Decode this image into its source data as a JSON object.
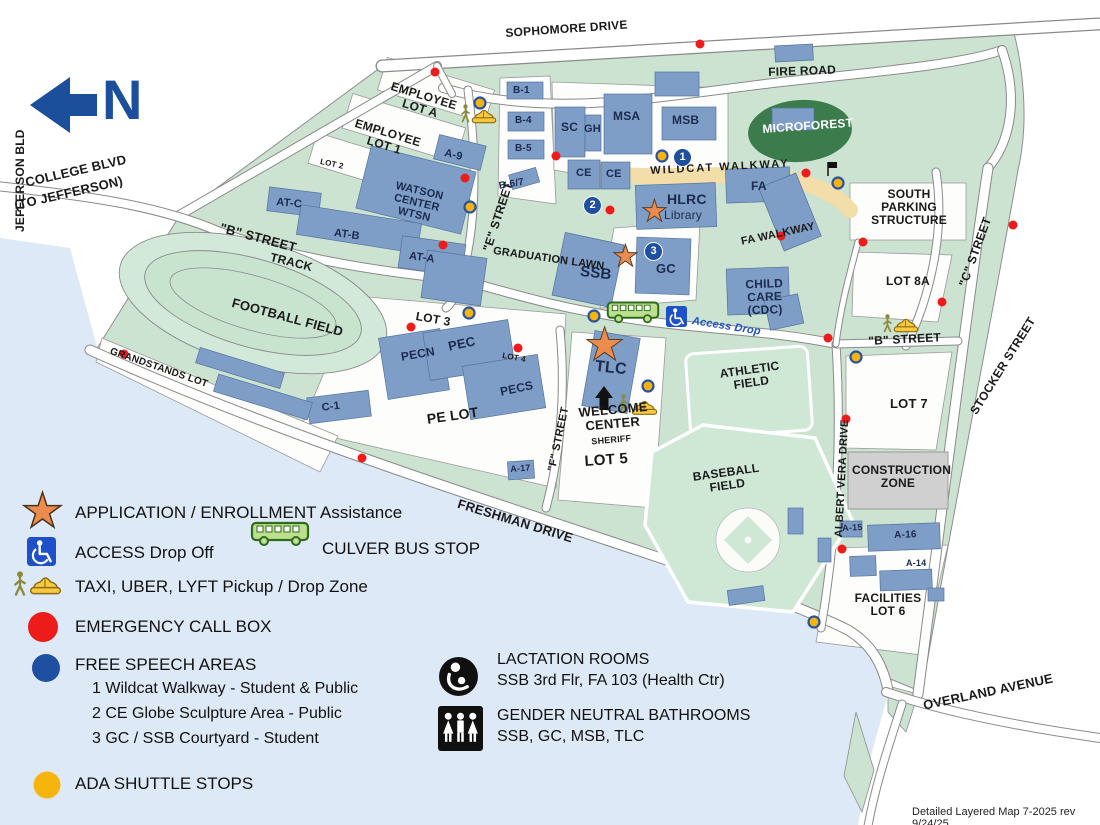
{
  "colors": {
    "campus_green": "#CBE3D0",
    "water_blue": "#DDE9F6",
    "building_blue": "#7E9EC8",
    "microforest_green": "#3B7B4C",
    "walkway_tan": "#F3DDA8",
    "construction_gray": "#D0D0D0",
    "emergency_red": "#EE1B1B",
    "ada_yellow": "#F6B40D",
    "free_speech_blue": "#1E4FA0",
    "star_orange": "#EB8B4D",
    "north_blue": "#1B4F9C",
    "access_blue": "#1E50C8",
    "bus_green": "#BCE08E",
    "taxi_yellow": "#F8C93E"
  },
  "icons": {
    "star": "★"
  },
  "north": {
    "label": "N"
  },
  "roads": {
    "jefferson_bld": "JEFFERSON BLD",
    "college_blvd": "COLLEGE BLVD",
    "to_jefferson": "(TO JEFFERSON)",
    "sophomore_drive": "SOPHOMORE DRIVE",
    "fire_road": "FIRE ROAD",
    "b_street_west": "\"B\" STREET",
    "b_street_east": "\"B\" STREET",
    "e_street": "\"E\" STREET",
    "f_street": "\"F\" STREET",
    "c_street": "\"C\" STREET",
    "stocker_street": "STOCKER STREET",
    "albert_vera_drive": "ALBERT VERA DRIVE",
    "freshman_drive": "FRESHMAN DRIVE",
    "overland_avenue": "OVERLAND AVENUE"
  },
  "walkways": {
    "wildcat": "WILDCAT WALKWAY",
    "fa": "FA WALKWAY",
    "access_drop": "Access Drop"
  },
  "lots": {
    "employee_a": "EMPLOYEE\nLOT A",
    "employee_1": "EMPLOYEE\nLOT 1",
    "lot_2": "LOT 2",
    "lot_3": "LOT 3",
    "lot_4": "LOT 4",
    "lot_5": "LOT 5",
    "lot_7": "LOT 7",
    "lot_8a": "LOT 8A",
    "pe_lot": "PE LOT",
    "facilities_lot_6": "FACILITIES\nLOT 6",
    "grandstands": "GRANDSTANDS LOT",
    "south_parking": "SOUTH\nPARKING\nSTRUCTURE",
    "construction": "CONSTRUCTION\nZONE"
  },
  "features": {
    "microforest": "MICROFOREST",
    "track": "TRACK",
    "football": "FOOTBALL FIELD",
    "athletic": "ATHLETIC\nFIELD",
    "baseball": "BASEBALL\nFIELD",
    "graduation_lawn": "GRADUATION LAWN",
    "welcome_center": "WELCOME\nCENTER",
    "sheriff": "SHERIFF"
  },
  "buildings": {
    "b1": "B-1",
    "b4": "B-4",
    "b5": "B-5",
    "b67": "B-6/7",
    "sc": "SC",
    "gh": "GH",
    "msa": "MSA",
    "msb": "MSB",
    "ce_left": "CE",
    "ce_right": "CE",
    "hlrc": "HLRC",
    "hlrc_sub": "Library",
    "fa": "FA",
    "ssb": "SSB",
    "gc": "GC",
    "child_care": "CHILD\nCARE (CDC)",
    "tlc": "TLC",
    "watson": "WATSON CENTER\nWTSN",
    "a9": "A-9",
    "at_c": "AT-C",
    "at_b": "AT-B",
    "at_a": "AT-A",
    "pecn": "PECN",
    "pec": "PEC",
    "pecs": "PECS",
    "c1": "C-1",
    "a17": "A-17",
    "a15": "A-15",
    "a16": "A-16",
    "a14": "A-14"
  },
  "free_speech": {
    "m1": "1",
    "m2": "2",
    "m3": "3"
  },
  "legend": {
    "application": "APPLICATION / ENROLLMENT Assistance",
    "access": "ACCESS Drop Off",
    "culver_bus": "CULVER BUS STOP",
    "taxi": "TAXI, UBER, LYFT Pickup / Drop Zone",
    "emergency": "EMERGENCY CALL BOX",
    "free_speech_title": "FREE SPEECH AREAS",
    "free_speech_1": "1 Wildcat Walkway - Student & Public",
    "free_speech_2": "2 CE Globe Sculpture Area - Public",
    "free_speech_3": "3 GC / SSB Courtyard - Student",
    "ada": "ADA SHUTTLE STOPS",
    "lactation_title": "LACTATION ROOMS",
    "lactation_sub": "SSB 3rd Flr, FA 103 (Health Ctr)",
    "gnb_title": "GENDER NEUTRAL BATHROOMS",
    "gnb_sub": "SSB, GC, MSB, TLC"
  },
  "footer": "Detailed Layered Map 7-2025 rev 9/24/25"
}
